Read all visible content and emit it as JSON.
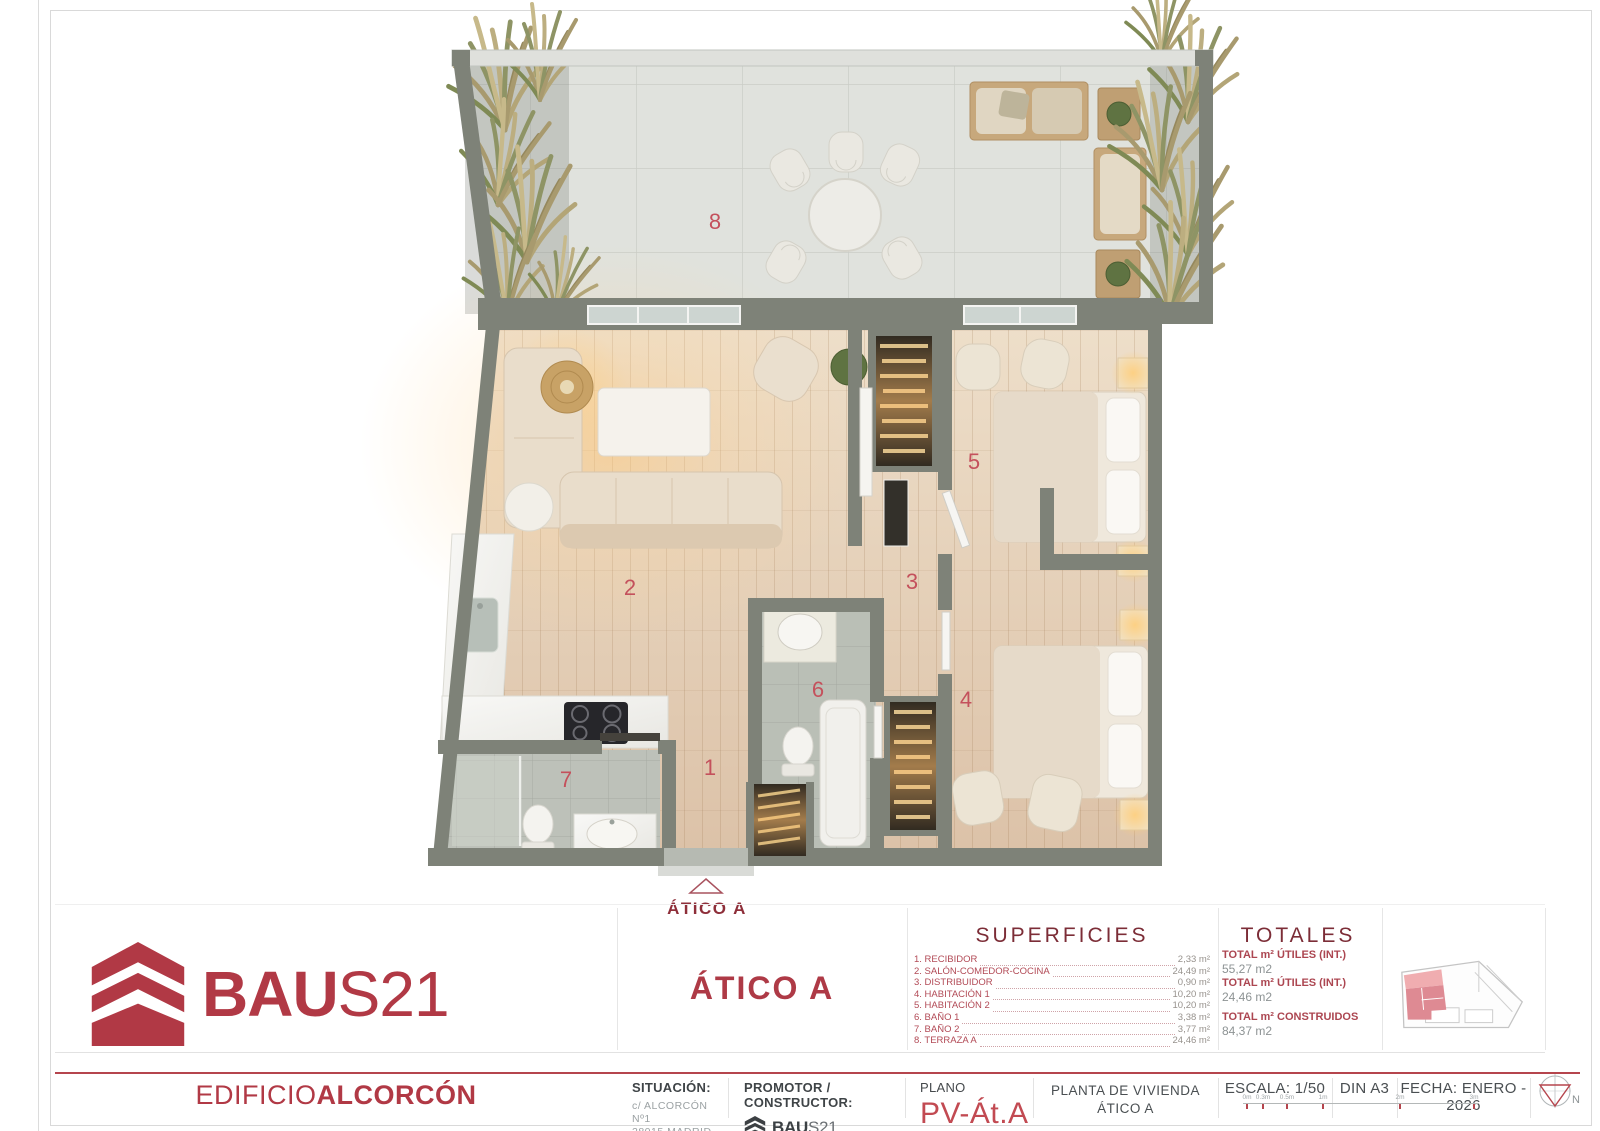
{
  "plan": {
    "room_numbers": {
      "n1": "1",
      "n2": "2",
      "n3": "3",
      "n4": "4",
      "n5": "5",
      "n6": "6",
      "n7": "7",
      "n8": "8"
    },
    "entrance_label": "ÁTICO A"
  },
  "title_block": {
    "logo": {
      "brand_bold": "BAU",
      "brand_light": "S21"
    },
    "unit_title": "ÁTICO A",
    "superficies": {
      "heading": "SUPERFICIES",
      "items": [
        {
          "label": "1. RECIBIDOR",
          "value": "2,33 m²"
        },
        {
          "label": "2. SALÓN-COMEDOR-COCINA",
          "value": "24,49 m²"
        },
        {
          "label": "3. DISTRIBUIDOR",
          "value": "0,90 m²"
        },
        {
          "label": "4. HABITACIÓN 1",
          "value": "10,20 m²"
        },
        {
          "label": "5. HABITACIÓN 2",
          "value": "10,20 m²"
        },
        {
          "label": "6. BAÑO 1",
          "value": "3,38 m²"
        },
        {
          "label": "7. BAÑO 2",
          "value": "3,77 m²"
        },
        {
          "label": "8. TERRAZA A",
          "value": "24,46 m²"
        }
      ]
    },
    "totales": {
      "heading": "TOTALES",
      "rows": [
        {
          "label": "TOTAL m² ÚTILES (INT.)",
          "value": "55,27 m2"
        },
        {
          "label": "TOTAL m² ÚTILES (INT.)",
          "value": "24,46 m2"
        },
        {
          "label": "TOTAL m² CONSTRUIDOS",
          "value": "84,37 m2"
        }
      ]
    }
  },
  "footer": {
    "building": {
      "prefix": "EDIFICIO",
      "name": "ALCORCÓN"
    },
    "situacion": {
      "label": "SITUACIÓN:",
      "line1": "c/ ALCORCÓN Nº1",
      "line2": "28015 MADRID"
    },
    "promotor": {
      "label": "PROMOTOR / CONSTRUCTOR:",
      "brand_bold": "BAU",
      "brand_light": "S21"
    },
    "plano": {
      "label": "PLANO",
      "code": "PV-Át.A"
    },
    "planta": {
      "line1": "PLANTA DE VIVIENDA",
      "line2": "ÁTICO A"
    },
    "escala": "ESCALA: 1/50",
    "din": "DIN A3",
    "fecha": "FECHA: ENERO - 2026",
    "scale_bar": {
      "labels": [
        "0m",
        "0.3m",
        "0.5m",
        "1m",
        "2m",
        "3m"
      ]
    },
    "north_label": "N"
  },
  "colors": {
    "brand_red": "#b13945",
    "accent_red": "#c4515c",
    "wall_gray": "#7e8278"
  }
}
